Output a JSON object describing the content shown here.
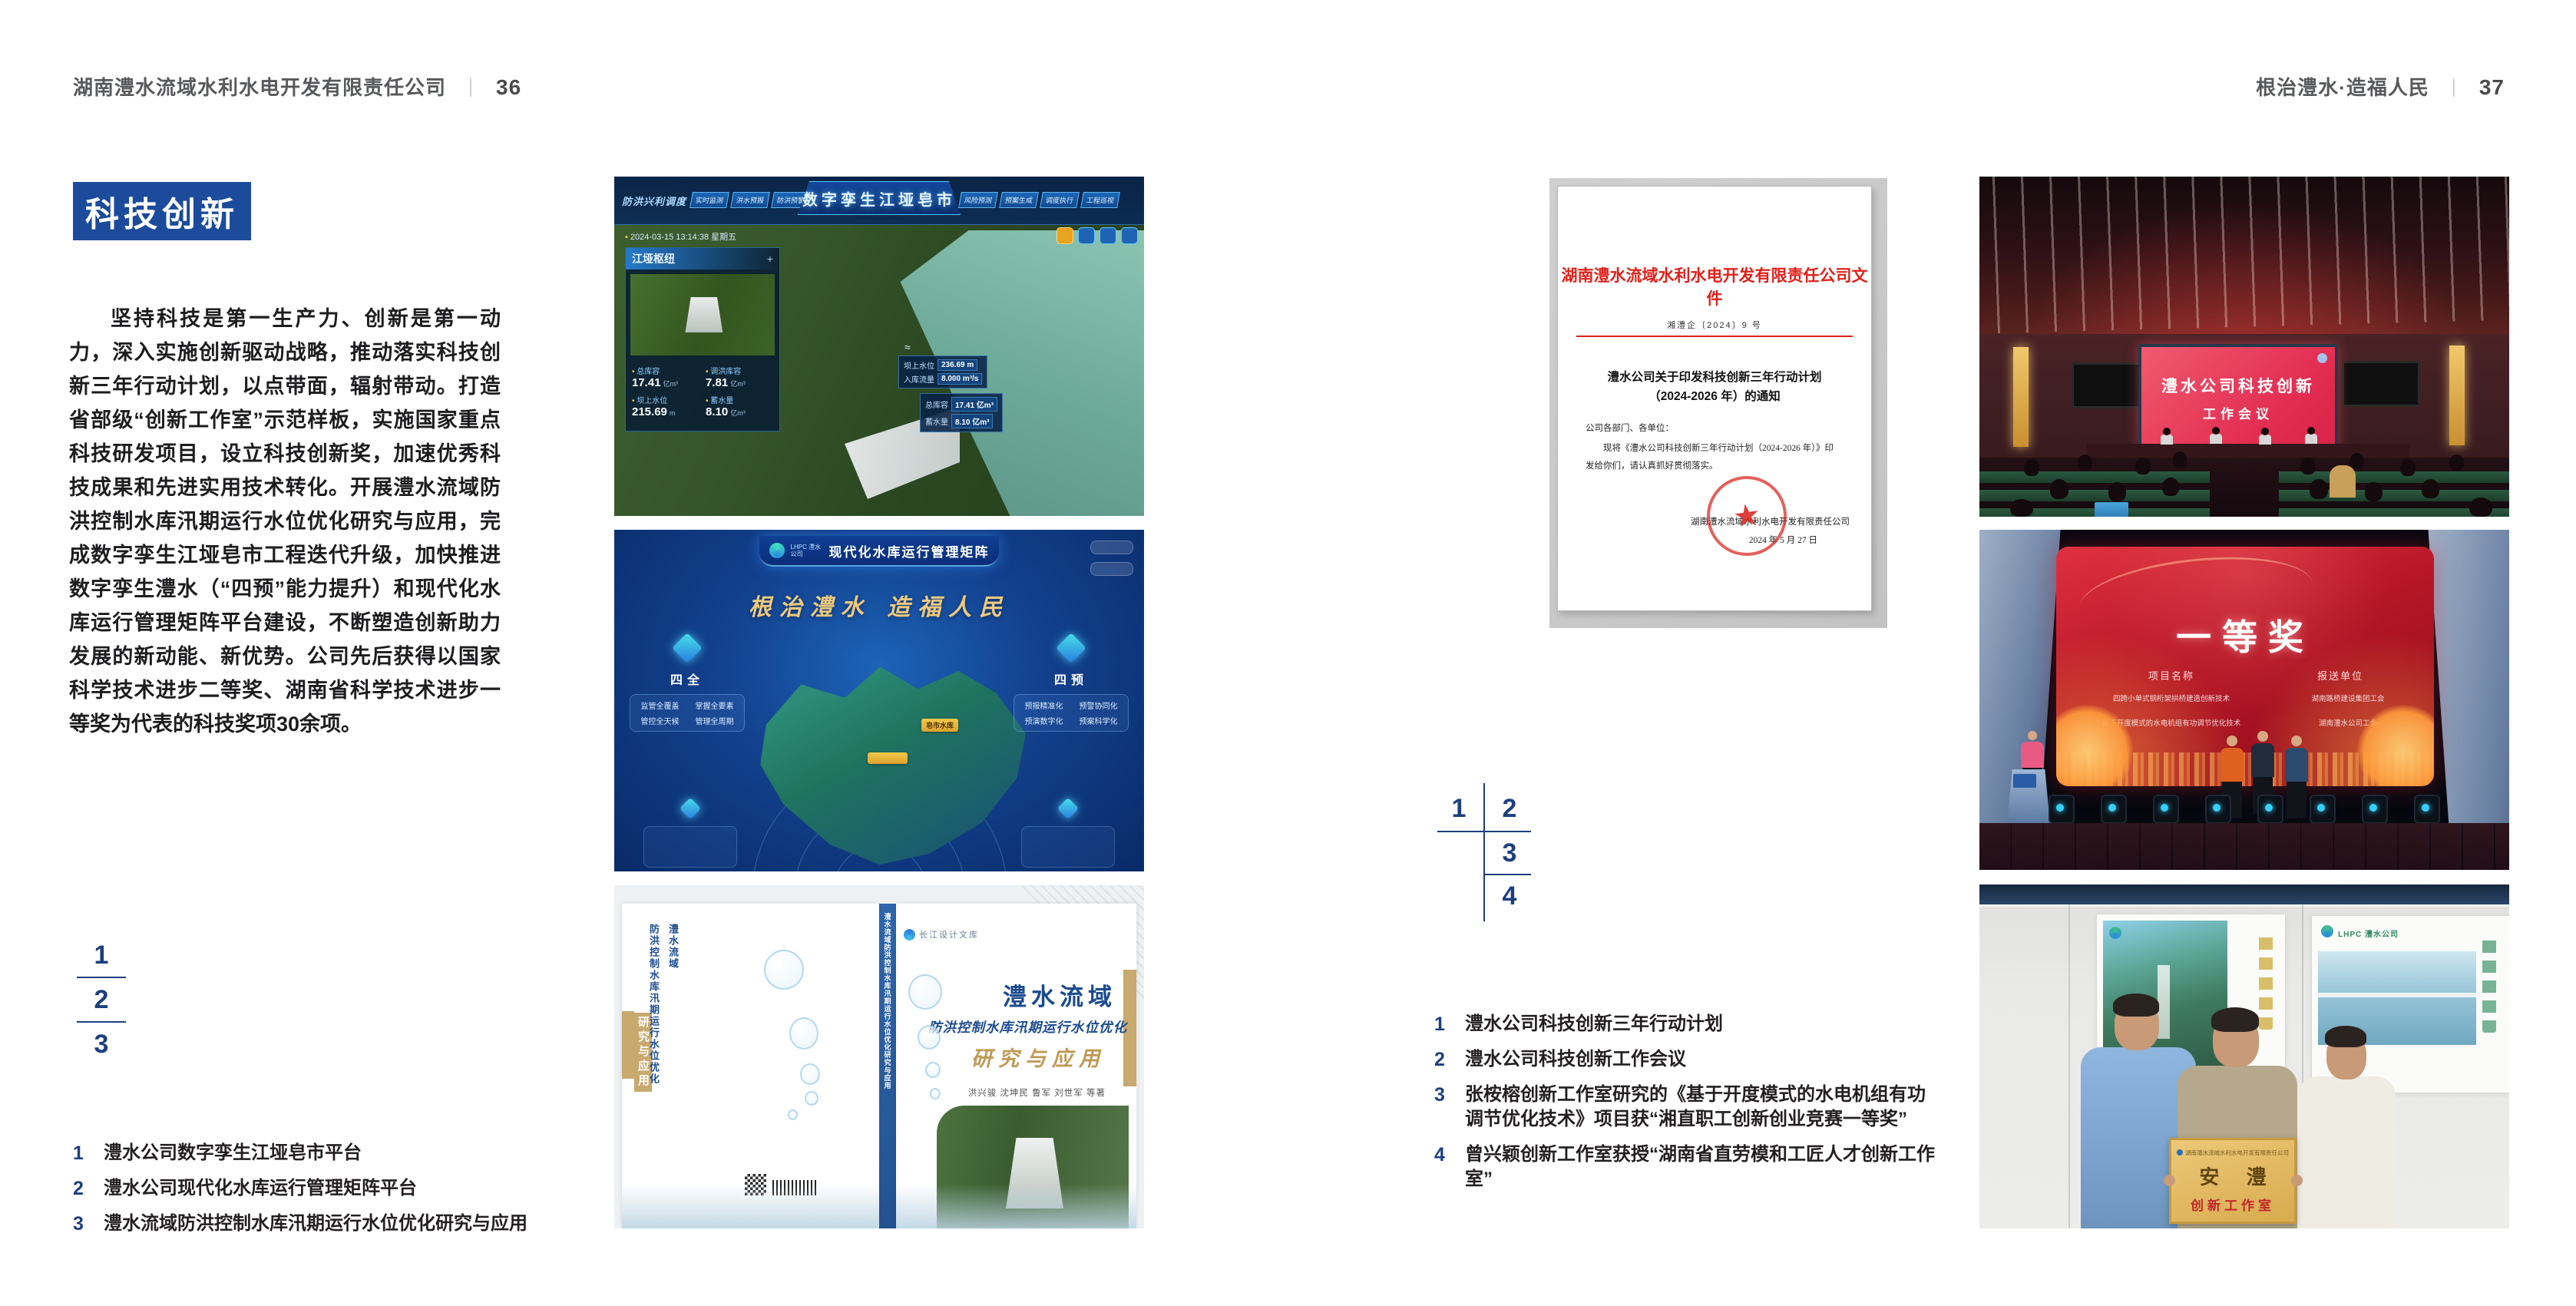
{
  "page_left": {
    "header": {
      "company": "湖南澧水流域水利水电开发有限责任公司",
      "separator": "｜",
      "page_number": "36"
    },
    "section_title": "科技创新",
    "body": "坚持科技是第一生产力、创新是第一动力，深入实施创新驱动战略，推动落实科技创新三年行动计划，以点带面，辐射带动。打造省部级“创新工作室”示范样板，实施国家重点科技研发项目，设立科技创新奖，加速优秀科技成果和先进实用技术转化。开展澧水流域防洪控制水库汛期运行水位优化研究与应用，完成数字孪生江垭皂市工程迭代升级，加快推进数字孪生澧水（“四预”能力提升）和现代化水库运行管理矩阵平台建设，不断塑造创新助力发展的新动能、新优势。公司先后获得以国家科学技术进步二等奖、湖南省科学技术进步一等奖为代表的科技奖项30余项。",
    "figure_index": [
      "1",
      "2",
      "3"
    ],
    "captions": [
      {
        "num": "1",
        "text": "澧水公司数字孪生江垭皂市平台"
      },
      {
        "num": "2",
        "text": "澧水公司现代化水库运行管理矩阵平台"
      },
      {
        "num": "3",
        "text": "澧水流域防洪控制水库汛期运行水位优化研究与应用"
      }
    ]
  },
  "page_right": {
    "header": {
      "slogan": "根治澧水·造福人民",
      "separator": "｜",
      "page_number": "37"
    },
    "figure_index": [
      "1",
      "2",
      "3",
      "4"
    ],
    "captions": [
      {
        "num": "1",
        "text": "澧水公司科技创新三年行动计划"
      },
      {
        "num": "2",
        "text": "澧水公司科技创新工作会议"
      },
      {
        "num": "3",
        "text": "张桉榕创新工作室研究的《基于开度模式的水电机组有功调节优化技术》项目获“湘直职工创新创业竞赛一等奖”"
      },
      {
        "num": "4",
        "text": "曾兴颖创新工作室获授“湖南省直劳模和工匠人才创新工作室”"
      }
    ]
  },
  "figures": {
    "digital_twin": {
      "brand": "防洪兴利调度",
      "title": "数字孪生江垭皂市",
      "tabs_left": [
        "实时监测",
        "洪水预报",
        "防洪预警"
      ],
      "tabs_right": [
        "风险预测",
        "预案生成",
        "调度执行",
        "工程巡视"
      ],
      "datetime": "2024-03-15 13:14:38 星期五",
      "panel_title": "江垭枢纽",
      "stats": [
        {
          "label": "总库容",
          "value": "17.41",
          "unit": "亿m³"
        },
        {
          "label": "调洪库容",
          "value": "7.81",
          "unit": "亿m³"
        },
        {
          "label": "坝上水位",
          "value": "215.69",
          "unit": "m"
        },
        {
          "label": "蓄水量",
          "value": "8.10",
          "unit": "亿m³"
        }
      ],
      "chips": [
        {
          "label": "坝上水位",
          "value": "236.69 m"
        },
        {
          "label": "入库流量",
          "value": "8.000 m³/s"
        },
        {
          "label": "总库容",
          "value": "17.41 亿m³"
        },
        {
          "label": "蓄水量",
          "value": "8.10 亿m³"
        }
      ]
    },
    "matrix": {
      "brand": "LHPC 澧水公司",
      "title": "现代化水库运行管理矩阵",
      "slogan": "根治澧水 造福人民",
      "left_group": {
        "name": "四全",
        "items": [
          "监管全覆盖",
          "掌握全要素",
          "管控全天候",
          "管理全周期"
        ]
      },
      "right_group": {
        "name": "四预",
        "items": [
          "预报精准化",
          "预警协同化",
          "预演数字化",
          "预案科学化"
        ]
      },
      "map_label": "皂市水库"
    },
    "book": {
      "publisher": "长江设计文库",
      "title_main": "澧水流域",
      "title_sub": "防洪控制水库汛期运行水位优化",
      "title_tail": "研究与应用",
      "authors": "洪兴骏 沈坤民 鲁军 刘世军 等著",
      "spine": "澧水流域防洪控制水库汛期运行水位优化研究与应用",
      "back_title_a": "澧水流域",
      "back_title_b": "防洪控制水库汛期运行水位优化",
      "back_title_c": "研究与应用"
    },
    "document": {
      "header": "湖南澧水流域水利水电开发有限责任公司文件",
      "doc_number": "湘澧企〔2024〕9 号",
      "title_line1": "澧水公司关于印发科技创新三年行动计划",
      "title_line2": "（2024-2026 年）的通知",
      "salutation": "公司各部门、各单位：",
      "body_line1": "现将《澧水公司科技创新三年行动计划（2024-2026 年）》印",
      "body_line2": "发给你们，请认真抓好贯彻落实。",
      "signer": "湖南澧水流域水利水电开发有限责任公司",
      "date": "2024 年 5 月 27 日",
      "seal_star": "★"
    },
    "meeting": {
      "screen_line1": "澧水公司科技创新",
      "screen_line2": "工作会议"
    },
    "award": {
      "title": "一等奖",
      "col_project": "项目名称",
      "col_org": "报送单位",
      "rows": [
        {
          "project": "四跨小单式钢桁架拱桥建造创新技术",
          "org": "湖南路桥建设集团工会"
        },
        {
          "project": "基于开度模式的水电机组有功调节优化技术",
          "org": "湖南澧水公司工会"
        }
      ]
    },
    "workshop": {
      "plaque_header": "湖南澧水流域水利水电开发有限责任公司",
      "plaque_name": "安 澧",
      "plaque_sub": "创新工作室",
      "poster_right_brand": "LHPC 澧水公司"
    }
  },
  "colors": {
    "accent_blue": "#1c4b9c",
    "index_navy": "#1d3f7f",
    "doc_red": "#e0201a",
    "ink": "#231f20"
  }
}
